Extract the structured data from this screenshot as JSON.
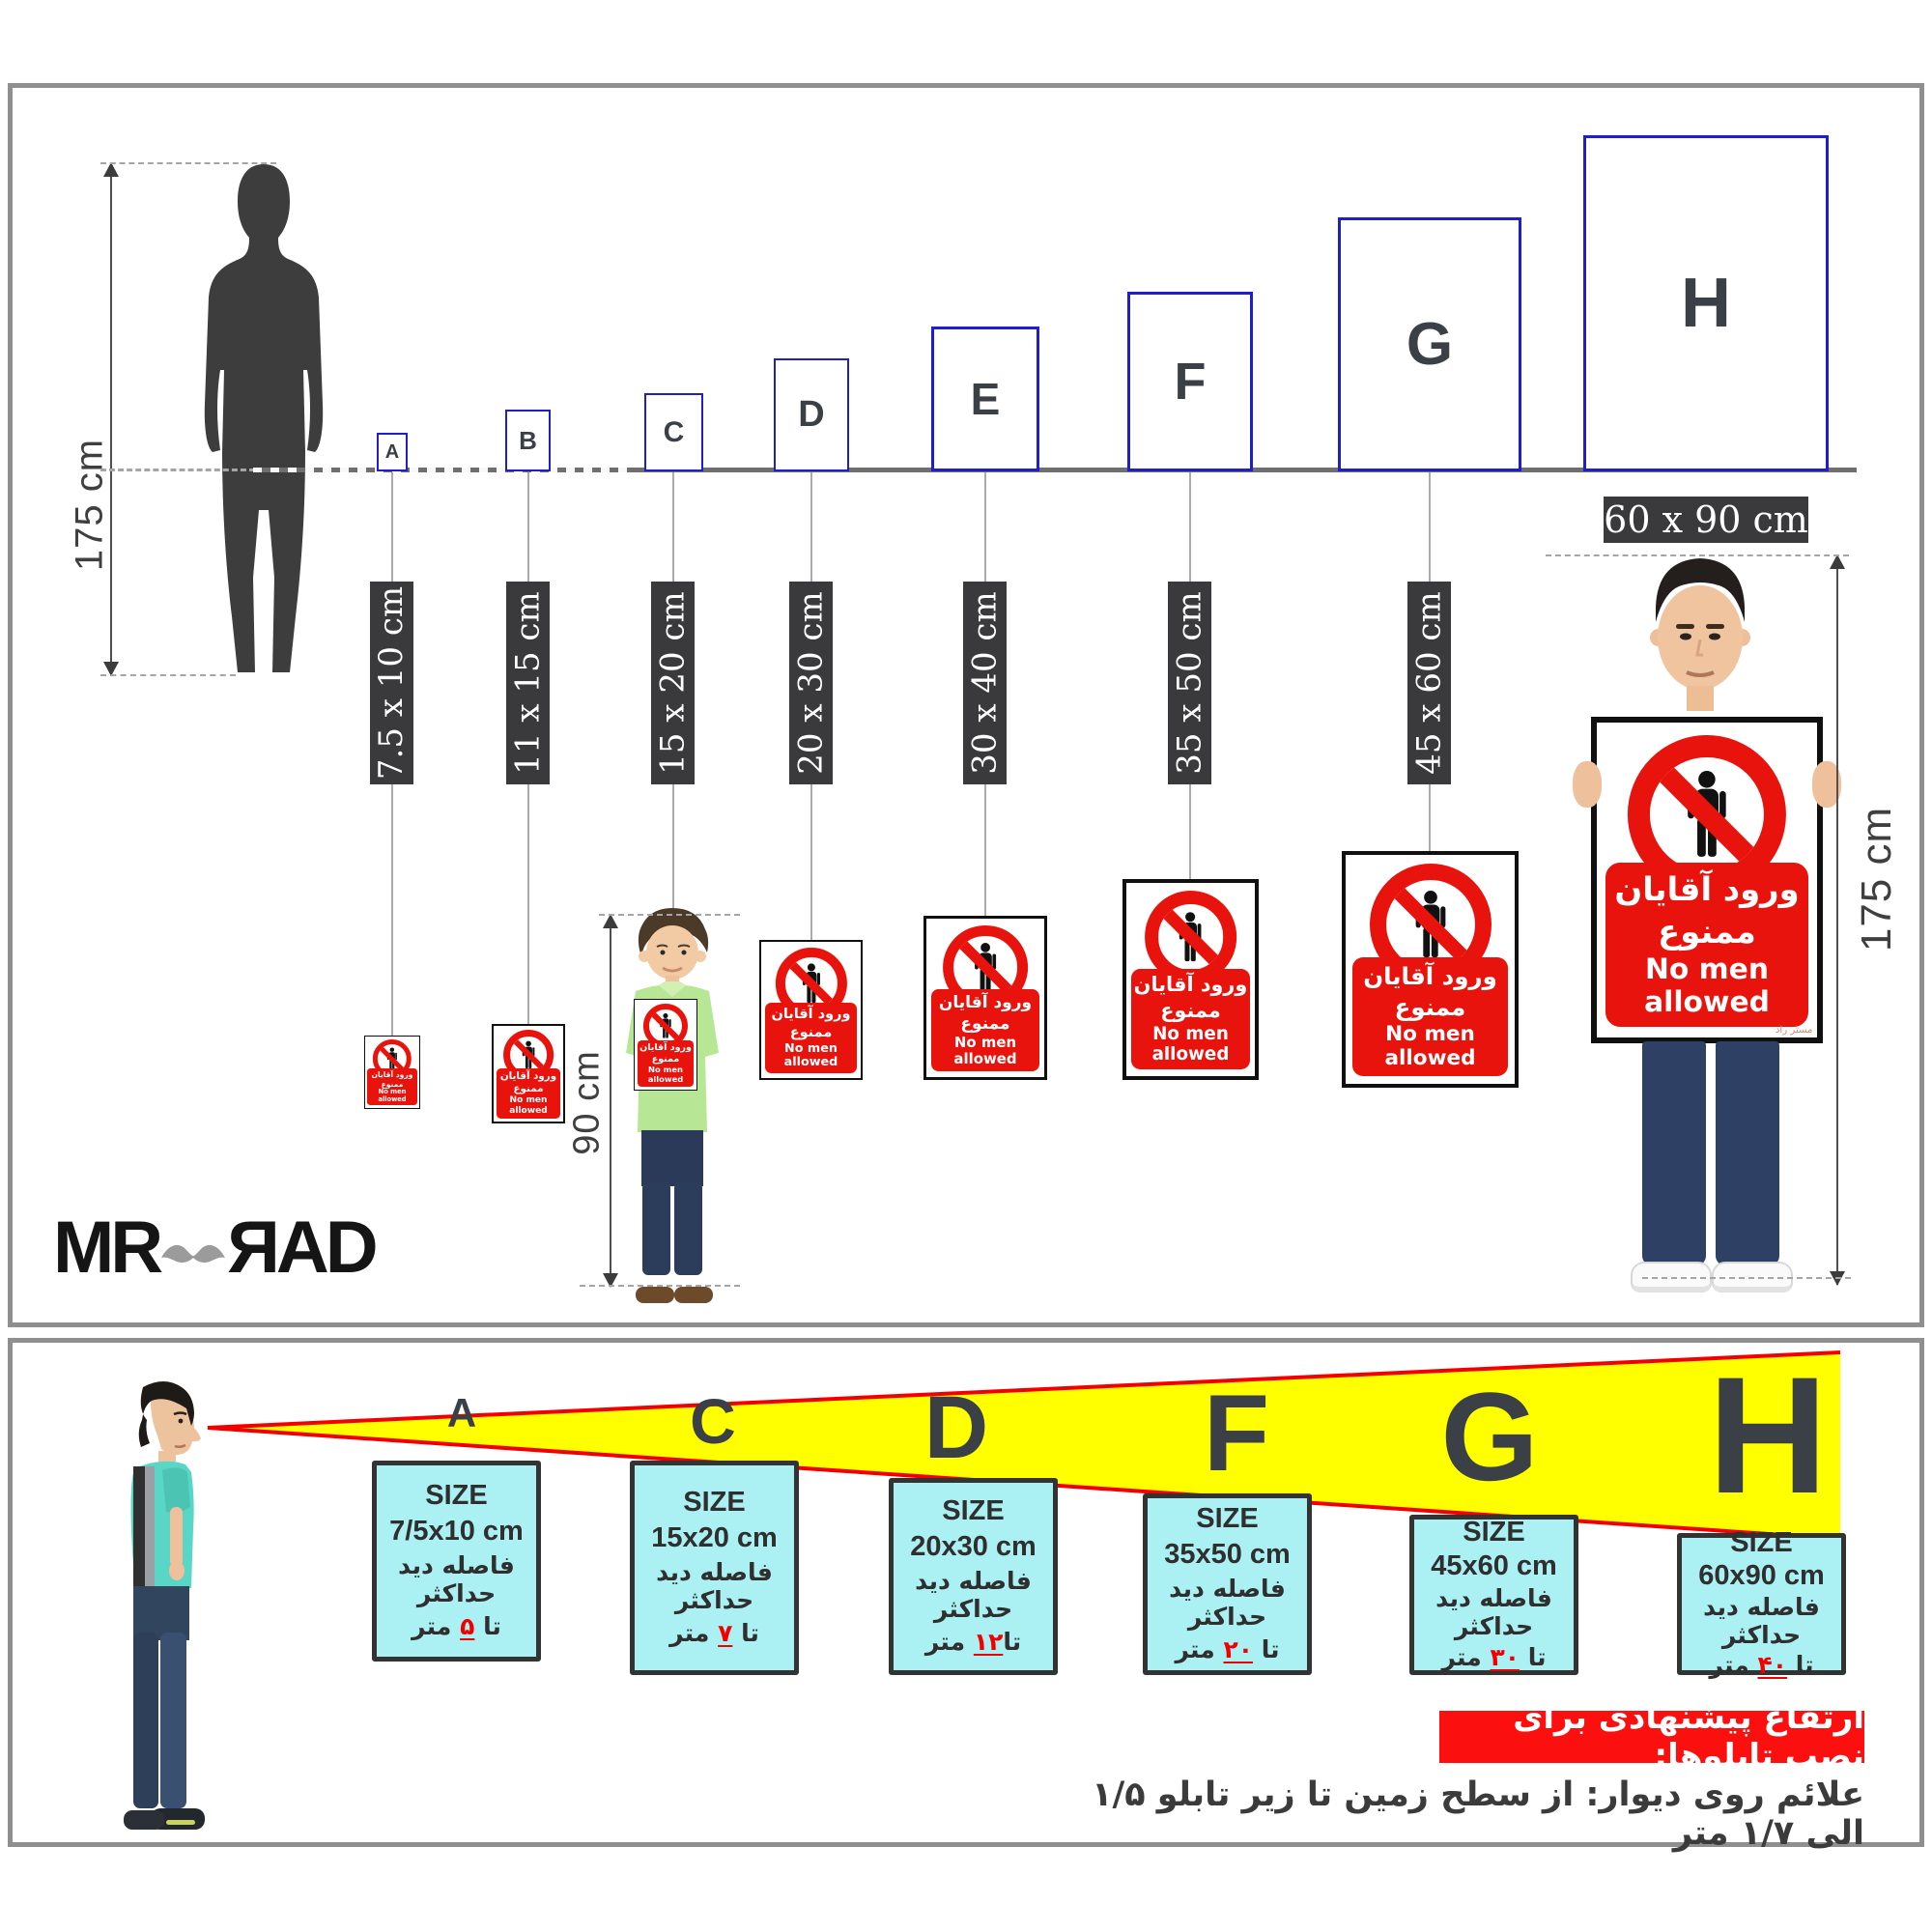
{
  "brand": {
    "mr": "MR",
    "rad": "ЯAD"
  },
  "sign": {
    "fa": "ورود آقایان ممنوع",
    "en": "No men allowed",
    "footer": "مستر راد"
  },
  "top": {
    "height_label": "175 cm",
    "child_height_label": "90 cm",
    "man_height_label": "175 cm",
    "big_size_label": "60 x 90 cm",
    "boxes": [
      {
        "letter": "A",
        "size": "7.5 x 10 cm"
      },
      {
        "letter": "B",
        "size": "11 x 15 cm"
      },
      {
        "letter": "C",
        "size": "15 x 20 cm"
      },
      {
        "letter": "D",
        "size": "20 x 30 cm"
      },
      {
        "letter": "E",
        "size": "30 x 40 cm"
      },
      {
        "letter": "F",
        "size": "35 x 50 cm"
      },
      {
        "letter": "G",
        "size": "45 x 60 cm"
      },
      {
        "letter": "H",
        "size": "60 x 90 cm"
      }
    ]
  },
  "bottom": {
    "letters": [
      "A",
      "C",
      "D",
      "F",
      "G",
      "H"
    ],
    "boards": [
      {
        "title": "SIZE",
        "size": "7/5x10 cm",
        "line1": "فاصله دید حداکثر",
        "upto": "تا",
        "meters": "۵",
        "unit": "متر"
      },
      {
        "title": "SIZE",
        "size": "15x20 cm",
        "line1": "فاصله دید حداکثر",
        "upto": "تا",
        "meters": "۷",
        "unit": "متر"
      },
      {
        "title": "SIZE",
        "size": "20x30 cm",
        "line1": "فاصله دید حداکثر",
        "upto": "تا",
        "meters": "۱۲",
        "unit": "متر"
      },
      {
        "title": "SIZE",
        "size": "35x50 cm",
        "line1": "فاصله دید حداکثر",
        "upto": "تا",
        "meters": "۲۰",
        "unit": "متر"
      },
      {
        "title": "SIZE",
        "size": "45x60 cm",
        "line1": "فاصله دید حداکثر",
        "upto": "تا",
        "meters": "۳۰",
        "unit": "متر"
      },
      {
        "title": "SIZE",
        "size": "60x90 cm",
        "line1": "فاصله دید حداکثر",
        "upto": "تا",
        "meters": "۴۰",
        "unit": "متر"
      }
    ],
    "note_title": "ارتفاع پیشنهادی برای نصب تابلوها:",
    "note_body": "علائم روی دیوار: از سطح زمین تا زیر تابلو ۱/۵ الی ۱/۷ متر"
  }
}
